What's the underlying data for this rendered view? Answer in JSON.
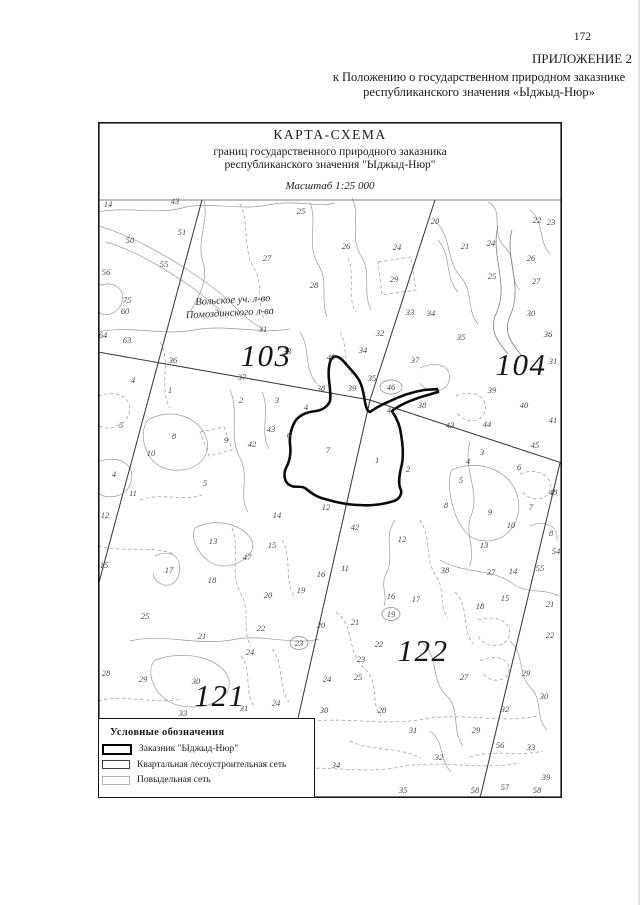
{
  "page_number": "172",
  "header": {
    "line1": "ПРИЛОЖЕНИЕ 2",
    "line2": "к Положению о государственном природном заказнике",
    "line3": "республиканского значения «Ыджыд-Нюр»"
  },
  "map": {
    "title": "КАРТА-СХЕМА",
    "subtitle1": "границ государственного природного заказника",
    "subtitle2": "республиканского значения \"Ыджыд-Нюр\"",
    "scale": "Масштаб 1:25 000",
    "area_label1": "Вольское уч. л-во",
    "area_label2": "Помоздинского л-ва",
    "quarter_numbers": [
      {
        "n": "103",
        "x": 266,
        "y": 355
      },
      {
        "n": "104",
        "x": 521,
        "y": 364
      },
      {
        "n": "121",
        "x": 220,
        "y": 695
      },
      {
        "n": "122",
        "x": 423,
        "y": 650
      }
    ],
    "parcel_numbers": [
      {
        "n": "14",
        "x": 108,
        "y": 204
      },
      {
        "n": "43",
        "x": 175,
        "y": 201
      },
      {
        "n": "25",
        "x": 301,
        "y": 211
      },
      {
        "n": "51",
        "x": 182,
        "y": 232
      },
      {
        "n": "50",
        "x": 130,
        "y": 240
      },
      {
        "n": "55",
        "x": 164,
        "y": 264
      },
      {
        "n": "56",
        "x": 106,
        "y": 272
      },
      {
        "n": "27",
        "x": 267,
        "y": 258
      },
      {
        "n": "75",
        "x": 127,
        "y": 300
      },
      {
        "n": "60",
        "x": 125,
        "y": 311
      },
      {
        "n": "64",
        "x": 103,
        "y": 335
      },
      {
        "n": "63",
        "x": 127,
        "y": 340
      },
      {
        "n": "20",
        "x": 435,
        "y": 221
      },
      {
        "n": "22",
        "x": 537,
        "y": 220
      },
      {
        "n": "23",
        "x": 551,
        "y": 222
      },
      {
        "n": "26",
        "x": 346,
        "y": 246
      },
      {
        "n": "24",
        "x": 397,
        "y": 247
      },
      {
        "n": "21",
        "x": 465,
        "y": 246
      },
      {
        "n": "24",
        "x": 491,
        "y": 243
      },
      {
        "n": "29",
        "x": 394,
        "y": 279
      },
      {
        "n": "25",
        "x": 492,
        "y": 276
      },
      {
        "n": "26",
        "x": 531,
        "y": 258
      },
      {
        "n": "27",
        "x": 536,
        "y": 281
      },
      {
        "n": "28",
        "x": 314,
        "y": 285
      },
      {
        "n": "30",
        "x": 531,
        "y": 313
      },
      {
        "n": "33",
        "x": 410,
        "y": 312
      },
      {
        "n": "34",
        "x": 431,
        "y": 313
      },
      {
        "n": "32",
        "x": 380,
        "y": 333
      },
      {
        "n": "35",
        "x": 461,
        "y": 337
      },
      {
        "n": "34",
        "x": 363,
        "y": 350
      },
      {
        "n": "31",
        "x": 263,
        "y": 329
      },
      {
        "n": "36",
        "x": 173,
        "y": 360
      },
      {
        "n": "37",
        "x": 242,
        "y": 377
      },
      {
        "n": "33",
        "x": 287,
        "y": 351
      },
      {
        "n": "40",
        "x": 331,
        "y": 357
      },
      {
        "n": "31",
        "x": 553,
        "y": 361
      },
      {
        "n": "37",
        "x": 415,
        "y": 360
      },
      {
        "n": "35",
        "x": 372,
        "y": 378
      },
      {
        "n": "36",
        "x": 548,
        "y": 334
      },
      {
        "n": "38",
        "x": 321,
        "y": 388
      },
      {
        "n": "39",
        "x": 352,
        "y": 388
      },
      {
        "n": "46",
        "x": 391,
        "y": 387
      },
      {
        "n": "42",
        "x": 391,
        "y": 410
      },
      {
        "n": "38",
        "x": 422,
        "y": 405
      },
      {
        "n": "43",
        "x": 450,
        "y": 425
      },
      {
        "n": "39",
        "x": 492,
        "y": 390
      },
      {
        "n": "40",
        "x": 524,
        "y": 405
      },
      {
        "n": "41",
        "x": 553,
        "y": 420
      },
      {
        "n": "44",
        "x": 487,
        "y": 424
      },
      {
        "n": "45",
        "x": 535,
        "y": 445
      },
      {
        "n": "48",
        "x": 553,
        "y": 492
      },
      {
        "n": "4",
        "x": 133,
        "y": 380
      },
      {
        "n": "1",
        "x": 170,
        "y": 390
      },
      {
        "n": "2",
        "x": 241,
        "y": 400
      },
      {
        "n": "3",
        "x": 277,
        "y": 400
      },
      {
        "n": "4",
        "x": 306,
        "y": 407
      },
      {
        "n": "5",
        "x": 121,
        "y": 425
      },
      {
        "n": "8",
        "x": 174,
        "y": 436
      },
      {
        "n": "43",
        "x": 271,
        "y": 429
      },
      {
        "n": "42",
        "x": 252,
        "y": 444
      },
      {
        "n": "9",
        "x": 226,
        "y": 440
      },
      {
        "n": "10",
        "x": 151,
        "y": 453
      },
      {
        "n": "6",
        "x": 289,
        "y": 435
      },
      {
        "n": "4",
        "x": 114,
        "y": 474
      },
      {
        "n": "5",
        "x": 205,
        "y": 483
      },
      {
        "n": "11",
        "x": 133,
        "y": 493
      },
      {
        "n": "12",
        "x": 105,
        "y": 515
      },
      {
        "n": "15",
        "x": 104,
        "y": 565
      },
      {
        "n": "7",
        "x": 328,
        "y": 450
      },
      {
        "n": "1",
        "x": 377,
        "y": 460
      },
      {
        "n": "2",
        "x": 408,
        "y": 469
      },
      {
        "n": "3",
        "x": 482,
        "y": 452
      },
      {
        "n": "4",
        "x": 468,
        "y": 461
      },
      {
        "n": "6",
        "x": 519,
        "y": 467
      },
      {
        "n": "5",
        "x": 461,
        "y": 480
      },
      {
        "n": "8",
        "x": 446,
        "y": 505
      },
      {
        "n": "9",
        "x": 490,
        "y": 512
      },
      {
        "n": "7",
        "x": 531,
        "y": 507
      },
      {
        "n": "10",
        "x": 511,
        "y": 525
      },
      {
        "n": "8",
        "x": 551,
        "y": 533
      },
      {
        "n": "54",
        "x": 556,
        "y": 551
      },
      {
        "n": "55",
        "x": 540,
        "y": 568
      },
      {
        "n": "13",
        "x": 484,
        "y": 545
      },
      {
        "n": "38",
        "x": 445,
        "y": 570
      },
      {
        "n": "37",
        "x": 491,
        "y": 572
      },
      {
        "n": "14",
        "x": 513,
        "y": 571
      },
      {
        "n": "15",
        "x": 505,
        "y": 598
      },
      {
        "n": "18",
        "x": 480,
        "y": 606
      },
      {
        "n": "21",
        "x": 550,
        "y": 604
      },
      {
        "n": "12",
        "x": 326,
        "y": 507
      },
      {
        "n": "14",
        "x": 277,
        "y": 515
      },
      {
        "n": "13",
        "x": 213,
        "y": 541
      },
      {
        "n": "15",
        "x": 272,
        "y": 545
      },
      {
        "n": "47",
        "x": 247,
        "y": 557
      },
      {
        "n": "17",
        "x": 169,
        "y": 570
      },
      {
        "n": "18",
        "x": 212,
        "y": 580
      },
      {
        "n": "16",
        "x": 321,
        "y": 574
      },
      {
        "n": "19",
        "x": 301,
        "y": 590
      },
      {
        "n": "20",
        "x": 268,
        "y": 595
      },
      {
        "n": "42",
        "x": 355,
        "y": 527
      },
      {
        "n": "12",
        "x": 402,
        "y": 539
      },
      {
        "n": "11",
        "x": 345,
        "y": 568
      },
      {
        "n": "16",
        "x": 391,
        "y": 596
      },
      {
        "n": "17",
        "x": 416,
        "y": 599
      },
      {
        "n": "19",
        "x": 391,
        "y": 614
      },
      {
        "n": "25",
        "x": 145,
        "y": 616
      },
      {
        "n": "21",
        "x": 202,
        "y": 636
      },
      {
        "n": "22",
        "x": 261,
        "y": 628
      },
      {
        "n": "20",
        "x": 321,
        "y": 625
      },
      {
        "n": "23",
        "x": 299,
        "y": 643
      },
      {
        "n": "24",
        "x": 250,
        "y": 652
      },
      {
        "n": "28",
        "x": 106,
        "y": 673
      },
      {
        "n": "29",
        "x": 143,
        "y": 679
      },
      {
        "n": "30",
        "x": 196,
        "y": 681
      },
      {
        "n": "31",
        "x": 244,
        "y": 708
      },
      {
        "n": "33",
        "x": 183,
        "y": 713
      },
      {
        "n": "24",
        "x": 276,
        "y": 703
      },
      {
        "n": "21",
        "x": 355,
        "y": 622
      },
      {
        "n": "22",
        "x": 379,
        "y": 644
      },
      {
        "n": "23",
        "x": 361,
        "y": 659
      },
      {
        "n": "24",
        "x": 327,
        "y": 679
      },
      {
        "n": "25",
        "x": 358,
        "y": 677
      },
      {
        "n": "30",
        "x": 324,
        "y": 710
      },
      {
        "n": "28",
        "x": 382,
        "y": 710
      },
      {
        "n": "34",
        "x": 336,
        "y": 765
      },
      {
        "n": "35",
        "x": 403,
        "y": 790
      },
      {
        "n": "27",
        "x": 464,
        "y": 677
      },
      {
        "n": "29",
        "x": 526,
        "y": 673
      },
      {
        "n": "30",
        "x": 544,
        "y": 696
      },
      {
        "n": "32",
        "x": 505,
        "y": 709
      },
      {
        "n": "29",
        "x": 476,
        "y": 730
      },
      {
        "n": "31",
        "x": 413,
        "y": 730
      },
      {
        "n": "32",
        "x": 439,
        "y": 757
      },
      {
        "n": "56",
        "x": 500,
        "y": 745
      },
      {
        "n": "33",
        "x": 531,
        "y": 747
      },
      {
        "n": "39",
        "x": 546,
        "y": 777
      },
      {
        "n": "22",
        "x": 550,
        "y": 635
      },
      {
        "n": "57",
        "x": 505,
        "y": 787
      },
      {
        "n": "58",
        "x": 475,
        "y": 790
      },
      {
        "n": "58",
        "x": 537,
        "y": 790
      }
    ]
  },
  "legend": {
    "title": "Условные обозначения",
    "items": [
      {
        "label": "Заказник \"Ыджыд-Нюр\"",
        "swatch": "reserve-boundary"
      },
      {
        "label": "Квартальная лесоустроительная сеть",
        "swatch": "quarter-net"
      },
      {
        "label": "Повыдельная сеть",
        "swatch": "parcel-net"
      }
    ]
  },
  "colors": {
    "paper": "#ffffff",
    "ink": "#1a1a1a",
    "thin_line": "#9a9a9a",
    "quarter_line": "#3b3b3b",
    "reserve_boundary": "#0c0c0c"
  }
}
